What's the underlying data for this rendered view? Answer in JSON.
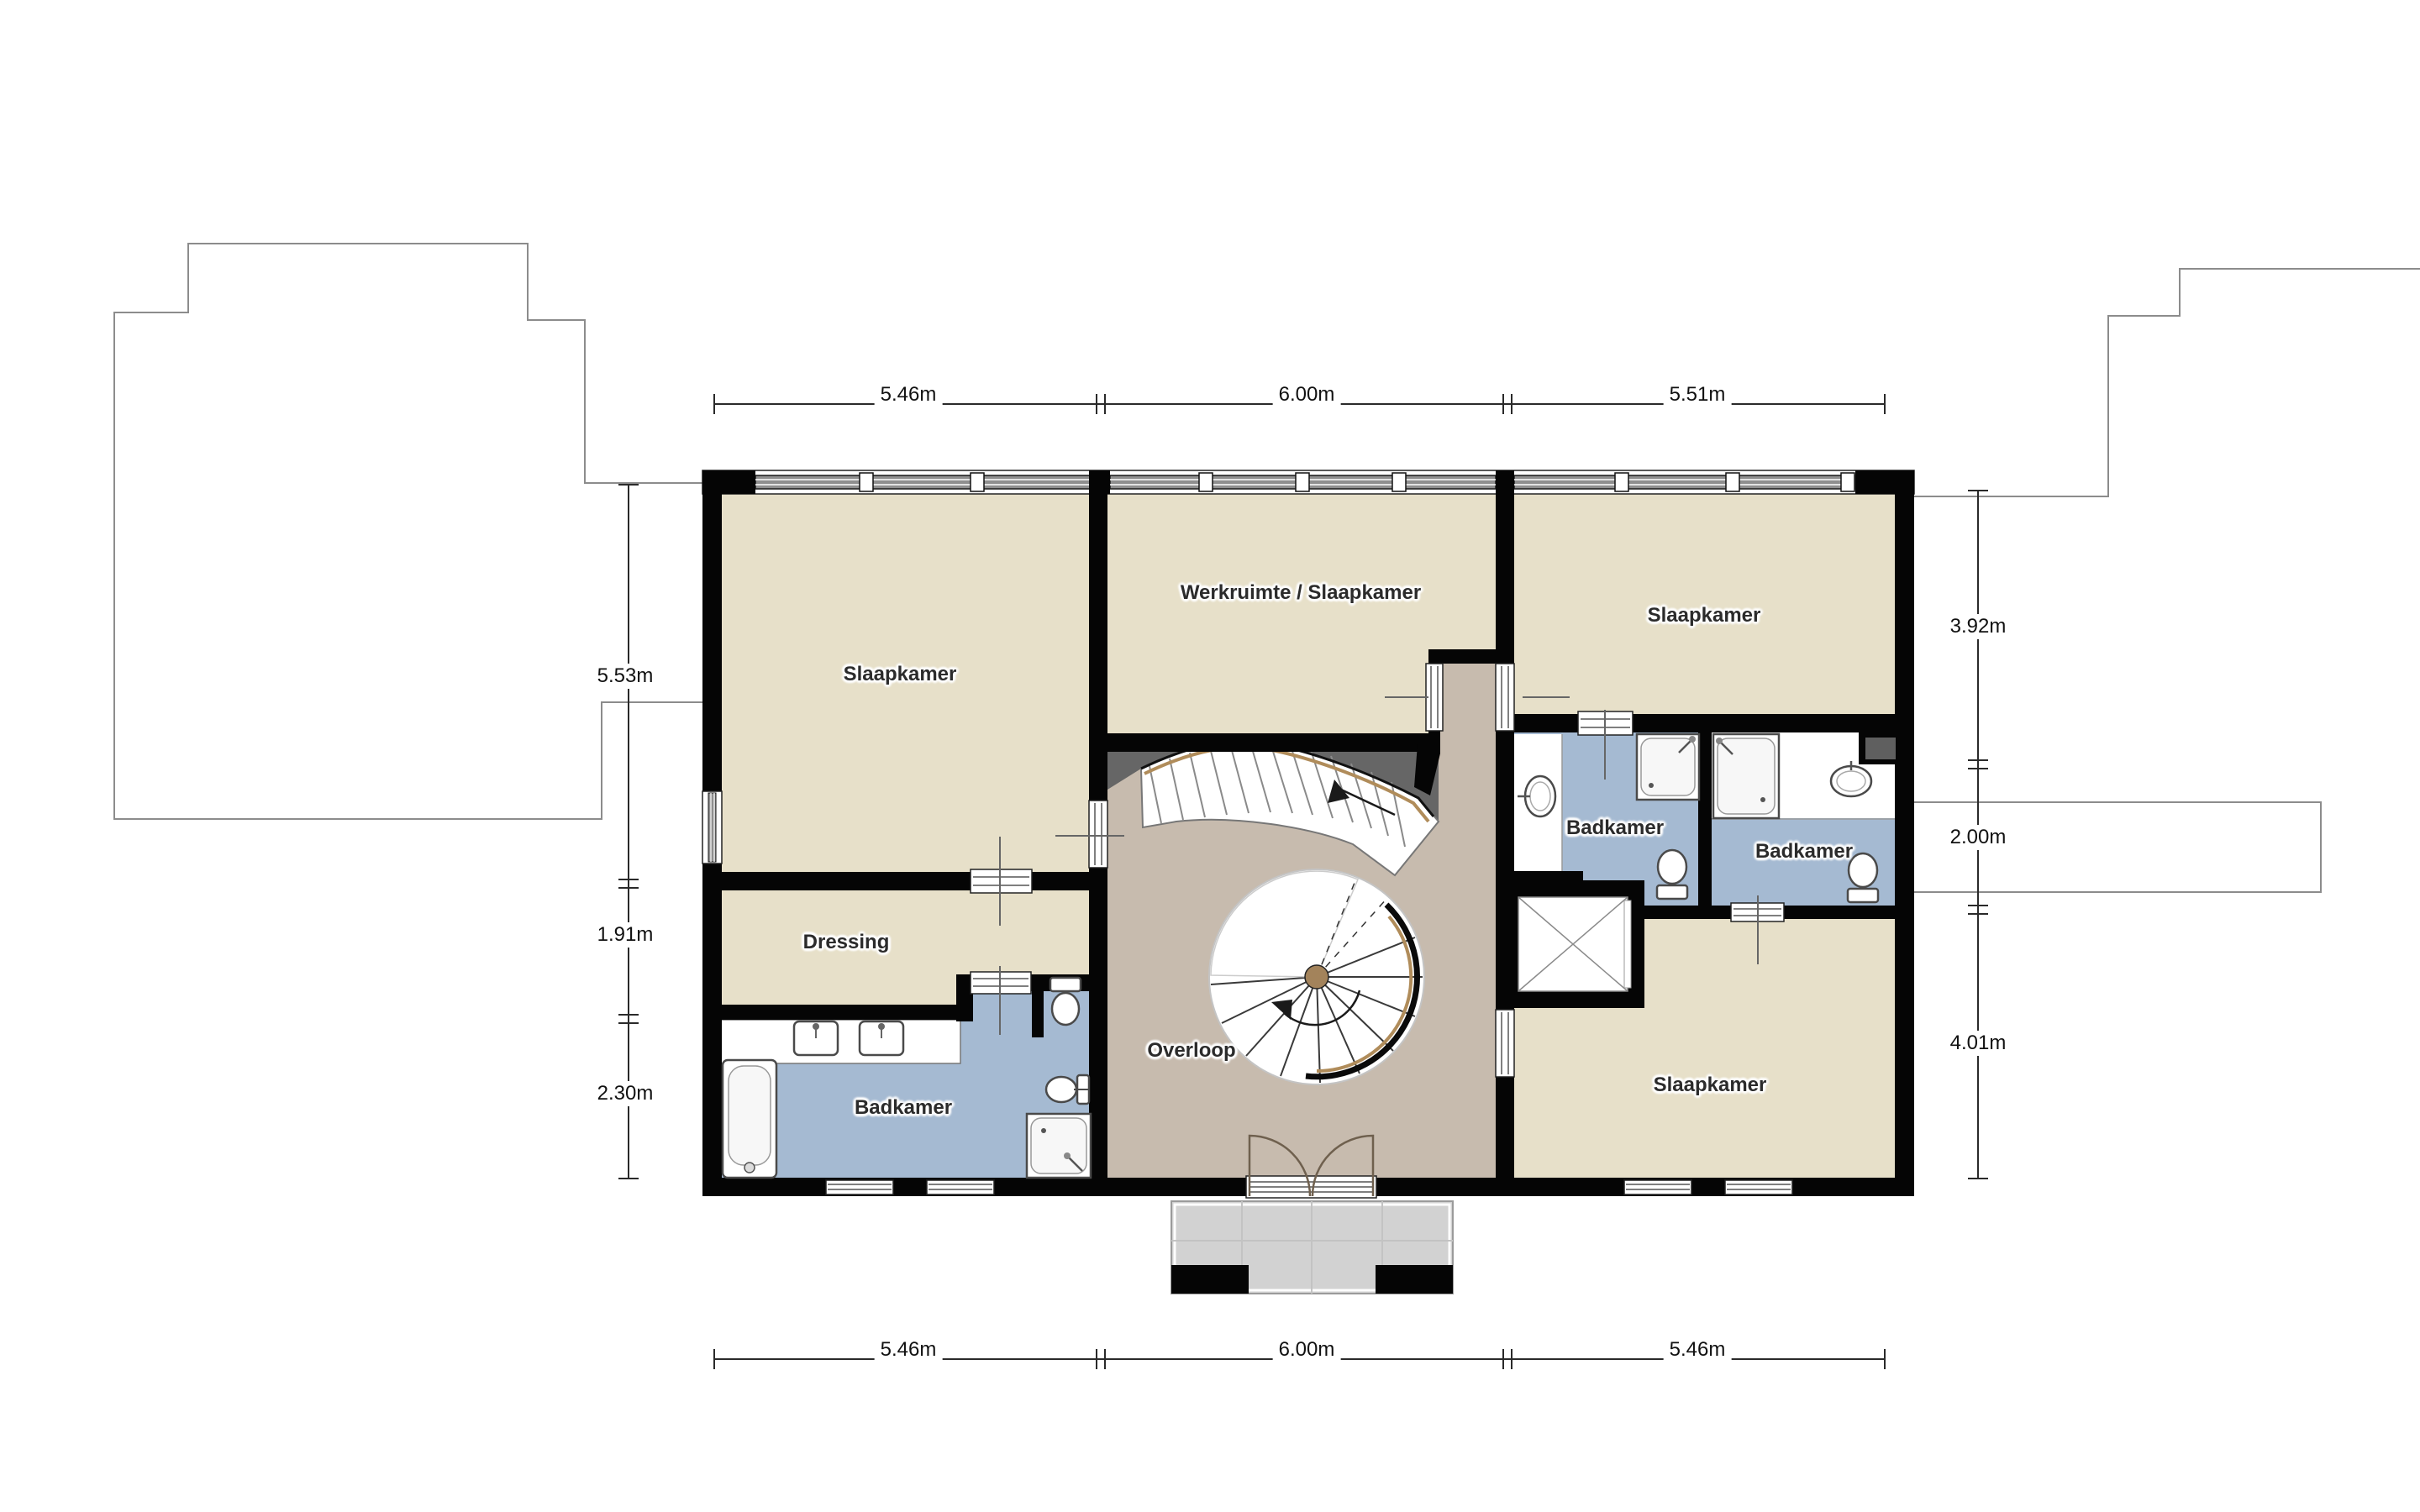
{
  "plan_title": "floor-plan",
  "rooms": [
    {
      "id": "slaapkamer-top-left",
      "label": "Slaapkamer"
    },
    {
      "id": "werkruimte",
      "label": "Werkruimte / Slaapkamer"
    },
    {
      "id": "slaapkamer-top-right",
      "label": "Slaapkamer"
    },
    {
      "id": "dressing",
      "label": "Dressing"
    },
    {
      "id": "badkamer-left",
      "label": "Badkamer"
    },
    {
      "id": "overloop",
      "label": "Overloop"
    },
    {
      "id": "badkamer-right-1",
      "label": "Badkamer"
    },
    {
      "id": "badkamer-right-2",
      "label": "Badkamer"
    },
    {
      "id": "slaapkamer-bottom-right",
      "label": "Slaapkamer"
    }
  ],
  "dimensions": {
    "top": [
      "5.46m",
      "6.00m",
      "5.51m"
    ],
    "bottom": [
      "5.46m",
      "6.00m",
      "5.46m"
    ],
    "left": [
      "5.53m",
      "1.91m",
      "2.30m"
    ],
    "right": [
      "3.92m",
      "2.00m",
      "4.01m"
    ]
  },
  "colors": {
    "room": "#e7e0c9",
    "hall": "#c7bbae",
    "bath": "#a5bad2",
    "wall": "#050505",
    "void": "#666666",
    "balcony": "#d2d2d2",
    "stringer": "#b08c5a"
  }
}
